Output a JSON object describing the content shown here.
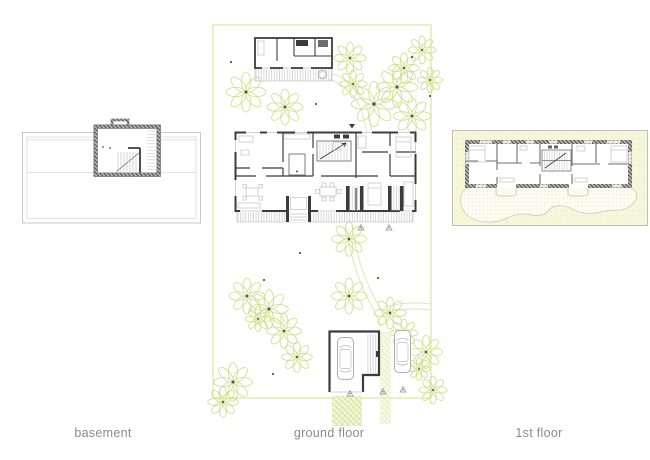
{
  "sheet": {
    "background": "#ffffff"
  },
  "panels": [
    {
      "id": "basement",
      "label": "basement"
    },
    {
      "id": "ground-floor",
      "label": "ground floor"
    },
    {
      "id": "first-floor",
      "label": "1st floor"
    }
  ],
  "icons": {
    "tree": "flower-canopy-tree",
    "car": "car-top-view",
    "section_marker": "triangle-marker",
    "hot_tub": "round-tub"
  },
  "colors": {
    "wall_dark": "#3c3c3c",
    "line_light": "#c4c4c4",
    "furniture": "#c9c9c9",
    "tree_green": "#cde08c",
    "boundary_green": "#e4ecb5",
    "path_green": "#dde8ba",
    "lawn_hatch": "#c9dc8e",
    "panel_yellow": "#f6f6db",
    "panel_border": "#b3b3a6",
    "label_gray": "#8a8a8a",
    "marker_dark": "#555555"
  }
}
